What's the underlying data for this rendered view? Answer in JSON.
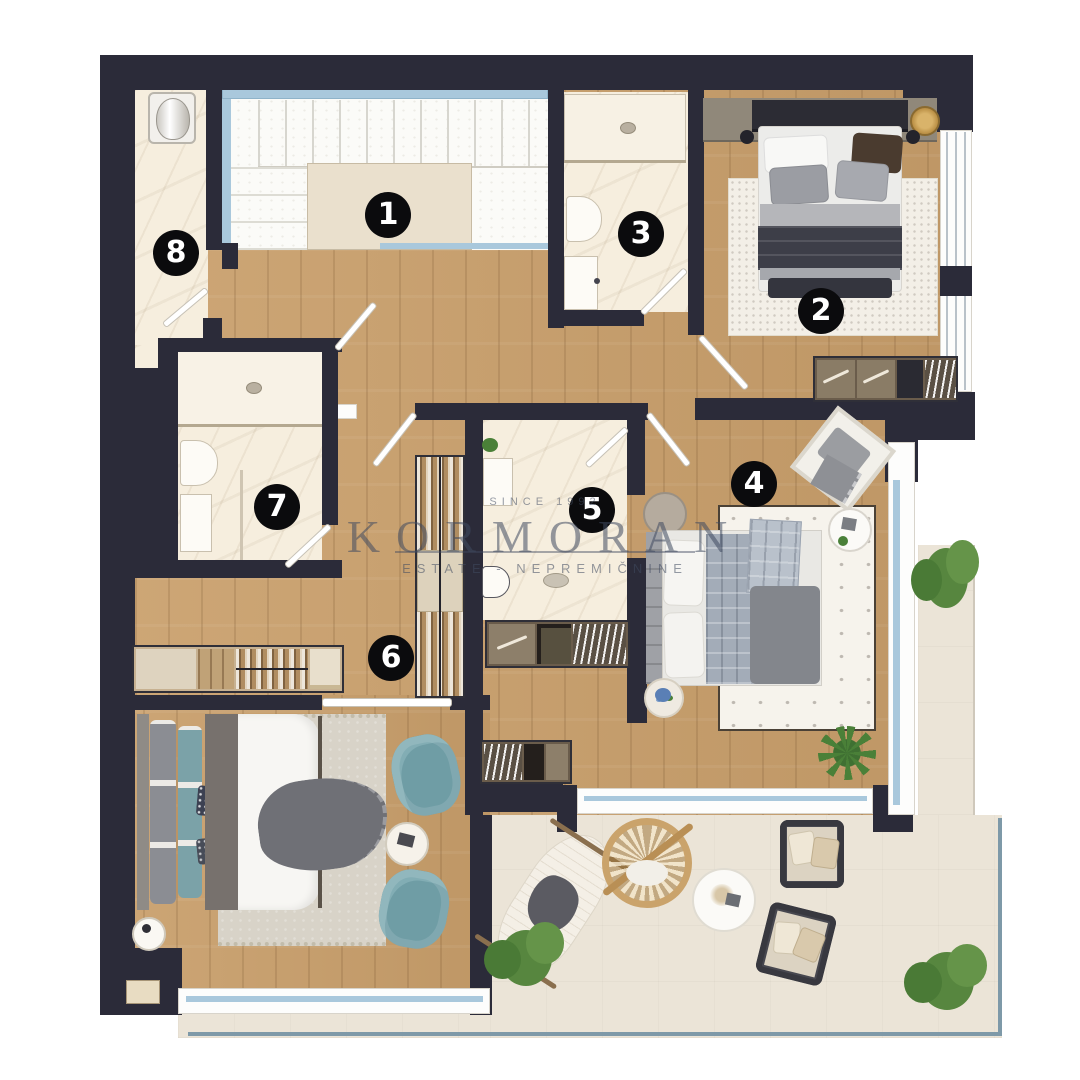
{
  "title": "Apartment floor plan",
  "watermark": {
    "since": "SINCE 1992",
    "brand": "KORMORAN",
    "tagline": "ESTATE - NEPREMIČNINE"
  },
  "rooms": [
    {
      "number": "1",
      "cx": 388,
      "cy": 215
    },
    {
      "number": "2",
      "cx": 821,
      "cy": 311
    },
    {
      "number": "3",
      "cx": 641,
      "cy": 234
    },
    {
      "number": "4",
      "cx": 754,
      "cy": 484
    },
    {
      "number": "5",
      "cx": 592,
      "cy": 510
    },
    {
      "number": "6",
      "cx": 391,
      "cy": 658
    },
    {
      "number": "7",
      "cx": 277,
      "cy": 507
    },
    {
      "number": "8",
      "cx": 176,
      "cy": 253
    }
  ],
  "colors": {
    "wall": "#2b2b39",
    "wood_floor": "#c99f6b",
    "marble_floor": "#f6eede",
    "terrace_floor": "#ebe4d7",
    "glass": "#a9c8dc",
    "teal_chair": "#6f9da5",
    "navy_duvet": "#3d3e48",
    "gold_tray": "#b98e44",
    "plant": "#4a8038",
    "badge_bg": "#0b0b0d",
    "badge_text": "#ffffff"
  }
}
